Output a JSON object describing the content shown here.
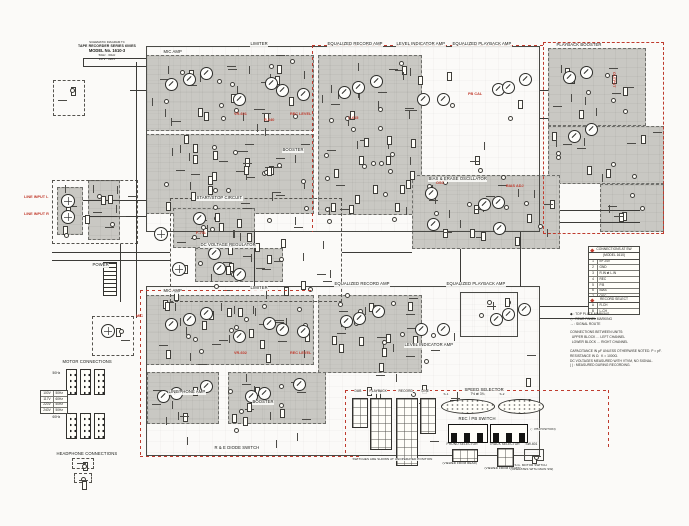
{
  "title_block": {
    "l1": "SCHEMATIC DIAGRAM TC",
    "l2": "TAPE RECORDER SERIES 600ES",
    "l3": "MODEL No. 1610-3",
    "l4": "50Hz · 60Hz",
    "l5": "117V · 220V"
  },
  "labels_black": [
    {
      "t": "MIC AMP",
      "x": 163,
      "y": 50
    },
    {
      "t": "LIMITER",
      "x": 250,
      "y": 42
    },
    {
      "t": "EQUALIZED RECORD AMP",
      "x": 327,
      "y": 42
    },
    {
      "t": "LEVEL INDICATOR AMP",
      "x": 396,
      "y": 42
    },
    {
      "t": "EQUALIZED PLAYBACK AMP",
      "x": 452,
      "y": 42
    },
    {
      "t": "PLAYBACK BOOSTER",
      "x": 556,
      "y": 43
    },
    {
      "t": "START/STOP CIRCUIT",
      "x": 196,
      "y": 196
    },
    {
      "t": "DC VOLTAGE REGULATOR",
      "x": 200,
      "y": 243
    },
    {
      "t": "BIAS & ERASE OSCILLATOR",
      "x": 428,
      "y": 177
    },
    {
      "t": "MIC AMP",
      "x": 163,
      "y": 289
    },
    {
      "t": "LIMITER",
      "x": 250,
      "y": 286
    },
    {
      "t": "EQUALIZED RECORD AMP",
      "x": 334,
      "y": 282
    },
    {
      "t": "EQUALIZED PLAYBACK AMP",
      "x": 446,
      "y": 282
    },
    {
      "t": "LEVEL INDICATOR AMP",
      "x": 404,
      "y": 343
    },
    {
      "t": "LINE/PHONE AMP",
      "x": 168,
      "y": 390
    },
    {
      "t": "BOOSTER",
      "x": 282,
      "y": 148
    },
    {
      "t": "BOOSTER",
      "x": 252,
      "y": 400
    },
    {
      "t": "POWER",
      "x": 92,
      "y": 263
    },
    {
      "t": "R & E DIODE SWITCH",
      "x": 214,
      "y": 446
    },
    {
      "t": "MOTOR CONNECTIONS",
      "x": 62,
      "y": 360
    },
    {
      "t": "HEADPHONE CONNECTIONS",
      "x": 56,
      "y": 452
    },
    {
      "t": "DUB",
      "x": 354,
      "y": 390,
      "fs": 3.2
    },
    {
      "t": "PLAYBACK",
      "x": 369,
      "y": 390,
      "fs": 3.2
    },
    {
      "t": "RECORD",
      "x": 398,
      "y": 390,
      "fs": 3.2
    },
    {
      "t": "LINE",
      "x": 421,
      "y": 390,
      "fs": 3.2
    },
    {
      "t": "SPEED SELECTOR",
      "x": 464,
      "y": 388
    },
    {
      "t": "7½ ⇄ 3¾",
      "x": 470,
      "y": 393,
      "fs": 3.2
    },
    {
      "t": "S-1",
      "x": 443,
      "y": 393,
      "fs": 3
    },
    {
      "t": "S-2",
      "x": 499,
      "y": 393,
      "fs": 3
    },
    {
      "t": "REC / PB SWITCH",
      "x": 458,
      "y": 417
    },
    {
      "t": "( : PB POSITION)",
      "x": 530,
      "y": 428,
      "fs": 3
    },
    {
      "t": "PHONO SELECTOR",
      "x": 446,
      "y": 443,
      "fs": 3.2
    },
    {
      "t": "(VIEWED FROM REAR)",
      "x": 442,
      "y": 462,
      "fs": 3
    },
    {
      "t": "TRACK SELECTOR",
      "x": 489,
      "y": 443,
      "fs": 3.2
    },
    {
      "t": "(VIEWED FROM FRONT)",
      "x": 484,
      "y": 467,
      "fs": 3
    },
    {
      "t": "SW-601",
      "x": 525,
      "y": 443,
      "fs": 3.2
    },
    {
      "t": "S.G. MOTOR SWITCH",
      "x": 514,
      "y": 464,
      "fs": 3
    },
    {
      "t": "(OPERATES WITH MAIN SW)",
      "x": 510,
      "y": 468,
      "fs": 3
    },
    {
      "t": "SWITCHES ARE SHOWN AT UNOPERATED POSITION",
      "x": 352,
      "y": 458,
      "fs": 3
    },
    {
      "t": "50Hz",
      "x": 52,
      "y": 372,
      "fs": 3.2
    },
    {
      "t": "60Hz",
      "x": 52,
      "y": 416,
      "fs": 3.2
    }
  ],
  "red_labels": [
    {
      "t": "LINE INPUT L",
      "x": 24,
      "y": 196
    },
    {
      "t": "LINE INPUT R",
      "x": 24,
      "y": 213
    },
    {
      "t": "MIC",
      "x": 136,
      "y": 315
    },
    {
      "t": "VR-601",
      "x": 234,
      "y": 113
    },
    {
      "t": "REC LEVEL",
      "x": 290,
      "y": 113
    },
    {
      "t": "R-640",
      "x": 264,
      "y": 119
    },
    {
      "t": "C-615",
      "x": 348,
      "y": 117
    },
    {
      "t": "PB CAL",
      "x": 468,
      "y": 93
    },
    {
      "t": "F-701",
      "x": 196,
      "y": 232
    },
    {
      "t": "OSC",
      "x": 436,
      "y": 182
    },
    {
      "t": "BIAS ADJ",
      "x": 506,
      "y": 185
    },
    {
      "t": "OUTPUT",
      "x": 611,
      "y": 72,
      "v": 1
    },
    {
      "t": "VR-602",
      "x": 234,
      "y": 352
    },
    {
      "t": "REC LEVEL",
      "x": 290,
      "y": 352
    }
  ],
  "geometry": {
    "gray_blocks": [
      {
        "x": 146,
        "y": 55,
        "w": 168,
        "h": 76
      },
      {
        "x": 146,
        "y": 134,
        "w": 168,
        "h": 80
      },
      {
        "x": 318,
        "y": 55,
        "w": 104,
        "h": 160
      },
      {
        "x": 548,
        "y": 48,
        "w": 98,
        "h": 78
      },
      {
        "x": 548,
        "y": 126,
        "w": 116,
        "h": 58
      },
      {
        "x": 600,
        "y": 184,
        "w": 64,
        "h": 48
      },
      {
        "x": 173,
        "y": 208,
        "w": 82,
        "h": 40
      },
      {
        "x": 195,
        "y": 248,
        "w": 88,
        "h": 34
      },
      {
        "x": 412,
        "y": 175,
        "w": 148,
        "h": 74
      },
      {
        "x": 57,
        "y": 187,
        "w": 26,
        "h": 48
      },
      {
        "x": 88,
        "y": 180,
        "w": 32,
        "h": 60
      },
      {
        "x": 146,
        "y": 295,
        "w": 168,
        "h": 70
      },
      {
        "x": 318,
        "y": 295,
        "w": 104,
        "h": 78
      },
      {
        "x": 147,
        "y": 372,
        "w": 72,
        "h": 52
      },
      {
        "x": 228,
        "y": 372,
        "w": 98,
        "h": 52
      }
    ],
    "outlines": [
      {
        "x": 146,
        "y": 46,
        "w": 394,
        "h": 186
      },
      {
        "x": 146,
        "y": 286,
        "w": 394,
        "h": 170
      },
      {
        "x": 460,
        "y": 292,
        "w": 58,
        "h": 45
      },
      {
        "x": 524,
        "y": 449,
        "w": 20,
        "h": 12
      }
    ],
    "dashed_boxes": [
      {
        "x": 170,
        "y": 198,
        "w": 172,
        "h": 104
      },
      {
        "x": 92,
        "y": 316,
        "w": 42,
        "h": 40
      },
      {
        "x": 52,
        "y": 180,
        "w": 86,
        "h": 64
      },
      {
        "x": 53,
        "y": 80,
        "w": 32,
        "h": 36
      },
      {
        "x": 72,
        "y": 458,
        "w": 22,
        "h": 11
      },
      {
        "x": 74,
        "y": 473,
        "w": 18,
        "h": 10
      }
    ],
    "red_rects": [
      {
        "x": 543,
        "y": 42,
        "w": 121,
        "h": 192
      }
    ],
    "red_lines": [
      {
        "x": 312,
        "y": 45,
        "w": 231,
        "h": 1
      },
      {
        "x": 312,
        "y": 45,
        "w": 1,
        "h": 187,
        "v": 1
      },
      {
        "x": 345,
        "y": 390,
        "w": 263,
        "h": 1
      },
      {
        "x": 608,
        "y": 390,
        "w": 1,
        "h": 57,
        "v": 1
      },
      {
        "x": 140,
        "y": 456,
        "w": 220,
        "h": 1
      },
      {
        "x": 140,
        "y": 290,
        "w": 1,
        "h": 166,
        "v": 1
      },
      {
        "x": 140,
        "y": 290,
        "w": 172,
        "h": 1
      },
      {
        "x": 345,
        "y": 390,
        "w": 1,
        "h": 66,
        "v": 1
      }
    ],
    "wires": [
      {
        "x": 83,
        "y": 58,
        "w": 63,
        "h": 1
      },
      {
        "x": 83,
        "y": 66,
        "w": 63,
        "h": 1
      },
      {
        "x": 83,
        "y": 58,
        "w": 1,
        "h": 9
      },
      {
        "x": 136,
        "y": 62,
        "w": 1,
        "h": 256
      },
      {
        "x": 130,
        "y": 90,
        "w": 16,
        "h": 1
      },
      {
        "x": 83,
        "y": 200,
        "w": 63,
        "h": 1
      },
      {
        "x": 83,
        "y": 216,
        "w": 63,
        "h": 1
      },
      {
        "x": 52,
        "y": 252,
        "w": 118,
        "h": 1
      },
      {
        "x": 52,
        "y": 260,
        "w": 118,
        "h": 1
      },
      {
        "x": 120,
        "y": 244,
        "w": 1,
        "h": 58
      },
      {
        "x": 540,
        "y": 90,
        "w": 8,
        "h": 1
      },
      {
        "x": 540,
        "y": 118,
        "w": 8,
        "h": 1
      },
      {
        "x": 540,
        "y": 306,
        "w": 56,
        "h": 1
      },
      {
        "x": 540,
        "y": 318,
        "w": 56,
        "h": 1
      },
      {
        "x": 560,
        "y": 210,
        "w": 80,
        "h": 1
      },
      {
        "x": 560,
        "y": 222,
        "w": 80,
        "h": 1
      },
      {
        "x": 460,
        "y": 249,
        "w": 1,
        "h": 38
      },
      {
        "x": 520,
        "y": 232,
        "w": 1,
        "h": 55
      },
      {
        "x": 254,
        "y": 232,
        "w": 1,
        "h": 54
      },
      {
        "x": 342,
        "y": 252,
        "w": 70,
        "h": 1
      }
    ],
    "transistors": [
      {
        "x": 170,
        "y": 83
      },
      {
        "x": 188,
        "y": 78
      },
      {
        "x": 205,
        "y": 72
      },
      {
        "x": 238,
        "y": 98
      },
      {
        "x": 270,
        "y": 82
      },
      {
        "x": 281,
        "y": 89
      },
      {
        "x": 302,
        "y": 93
      },
      {
        "x": 343,
        "y": 91
      },
      {
        "x": 357,
        "y": 86
      },
      {
        "x": 375,
        "y": 80
      },
      {
        "x": 422,
        "y": 98
      },
      {
        "x": 442,
        "y": 98
      },
      {
        "x": 497,
        "y": 88
      },
      {
        "x": 507,
        "y": 86
      },
      {
        "x": 524,
        "y": 78
      },
      {
        "x": 568,
        "y": 76
      },
      {
        "x": 585,
        "y": 71
      },
      {
        "x": 573,
        "y": 135
      },
      {
        "x": 590,
        "y": 128
      },
      {
        "x": 430,
        "y": 192
      },
      {
        "x": 432,
        "y": 223
      },
      {
        "x": 483,
        "y": 203
      },
      {
        "x": 497,
        "y": 201
      },
      {
        "x": 498,
        "y": 227
      },
      {
        "x": 198,
        "y": 217
      },
      {
        "x": 213,
        "y": 252
      },
      {
        "x": 218,
        "y": 267
      },
      {
        "x": 238,
        "y": 273
      },
      {
        "x": 170,
        "y": 323
      },
      {
        "x": 188,
        "y": 318
      },
      {
        "x": 205,
        "y": 312
      },
      {
        "x": 238,
        "y": 335
      },
      {
        "x": 268,
        "y": 322
      },
      {
        "x": 281,
        "y": 328
      },
      {
        "x": 302,
        "y": 330
      },
      {
        "x": 345,
        "y": 320
      },
      {
        "x": 358,
        "y": 317
      },
      {
        "x": 377,
        "y": 310
      },
      {
        "x": 420,
        "y": 328
      },
      {
        "x": 442,
        "y": 328
      },
      {
        "x": 495,
        "y": 318
      },
      {
        "x": 507,
        "y": 313
      },
      {
        "x": 523,
        "y": 308
      },
      {
        "x": 162,
        "y": 395
      },
      {
        "x": 175,
        "y": 392
      },
      {
        "x": 205,
        "y": 385
      },
      {
        "x": 250,
        "y": 395
      },
      {
        "x": 263,
        "y": 392
      },
      {
        "x": 298,
        "y": 383
      }
    ],
    "connectors": [
      {
        "x": 67,
        "y": 200
      },
      {
        "x": 67,
        "y": 216
      },
      {
        "x": 107,
        "y": 330
      },
      {
        "x": 160,
        "y": 233
      },
      {
        "x": 178,
        "y": 268
      }
    ],
    "plugs": [
      {
        "x": 66,
        "y": 369
      },
      {
        "x": 80,
        "y": 369
      },
      {
        "x": 94,
        "y": 369
      },
      {
        "x": 66,
        "y": 413
      },
      {
        "x": 80,
        "y": 413
      },
      {
        "x": 94,
        "y": 413
      }
    ],
    "swgrids": [
      {
        "x": 352,
        "y": 398,
        "w": 14,
        "h": 28
      },
      {
        "x": 370,
        "y": 398,
        "w": 20,
        "h": 50
      },
      {
        "x": 396,
        "y": 398,
        "w": 20,
        "h": 66
      },
      {
        "x": 420,
        "y": 398,
        "w": 14,
        "h": 34
      },
      {
        "x": 452,
        "y": 449,
        "w": 24,
        "h": 11
      },
      {
        "x": 497,
        "y": 448,
        "w": 15,
        "h": 17
      }
    ],
    "ovals": [
      {
        "x": 441,
        "y": 399,
        "w": 52,
        "h": 13
      },
      {
        "x": 498,
        "y": 399,
        "w": 44,
        "h": 13
      }
    ],
    "swrects": [
      {
        "x": 448,
        "y": 424,
        "w": 38,
        "h": 17
      },
      {
        "x": 490,
        "y": 424,
        "w": 36,
        "h": 17
      }
    ]
  },
  "right_tables": {
    "t1": {
      "title1": "CONNECTIONS AT SW",
      "title2": "(MODEL 1610)",
      "rows": [
        {
          "n": "1",
          "v": "B+ 24V"
        },
        {
          "n": "2",
          "v": "GND"
        },
        {
          "n": "3",
          "v": "R.IN ⇄ L.IN"
        },
        {
          "n": "4",
          "v": "REC"
        },
        {
          "n": "5",
          "v": "P.B"
        },
        {
          "n": "6",
          "v": "BIAS"
        },
        {
          "n": "7",
          "v": "OSC"
        },
        {
          "n": "8",
          "v": "MOTOR"
        }
      ]
    },
    "t2": {
      "title": "RECORD SELECT",
      "rows": [
        {
          "n": "A",
          "v": "R-CH"
        },
        {
          "n": "B",
          "v": "L-CH"
        }
      ]
    }
  },
  "notes": {
    "lines": [
      "◆ : TOP PLATE MARKING",
      "◇ : REAR PANEL MARKING",
      "→ : SIGNAL ROUTE",
      "",
      "CONNECTIONS BETWEEN UNITS:",
      "  UPPER BLOCK … LEFT CHANNEL",
      "  LOWER BLOCK … RIGHT CHANNEL",
      "",
      "CAPACITANCE IN µF UNLESS OTHERWISE NOTED. P = pF.",
      "RESISTANCE IN Ω.  K = 1000Ω.",
      "DC VOLTAGES MEASURED WITH VTVM, NO SIGNAL.",
      "( ) : MEASURED DURING RECORDING."
    ]
  },
  "motor_table": {
    "rows": [
      {
        "n": "100V",
        "v": "50Hz"
      },
      {
        "n": "117V",
        "v": "60Hz"
      },
      {
        "n": "220V",
        "v": "50Hz"
      },
      {
        "n": "240V",
        "v": "50Hz"
      }
    ]
  }
}
